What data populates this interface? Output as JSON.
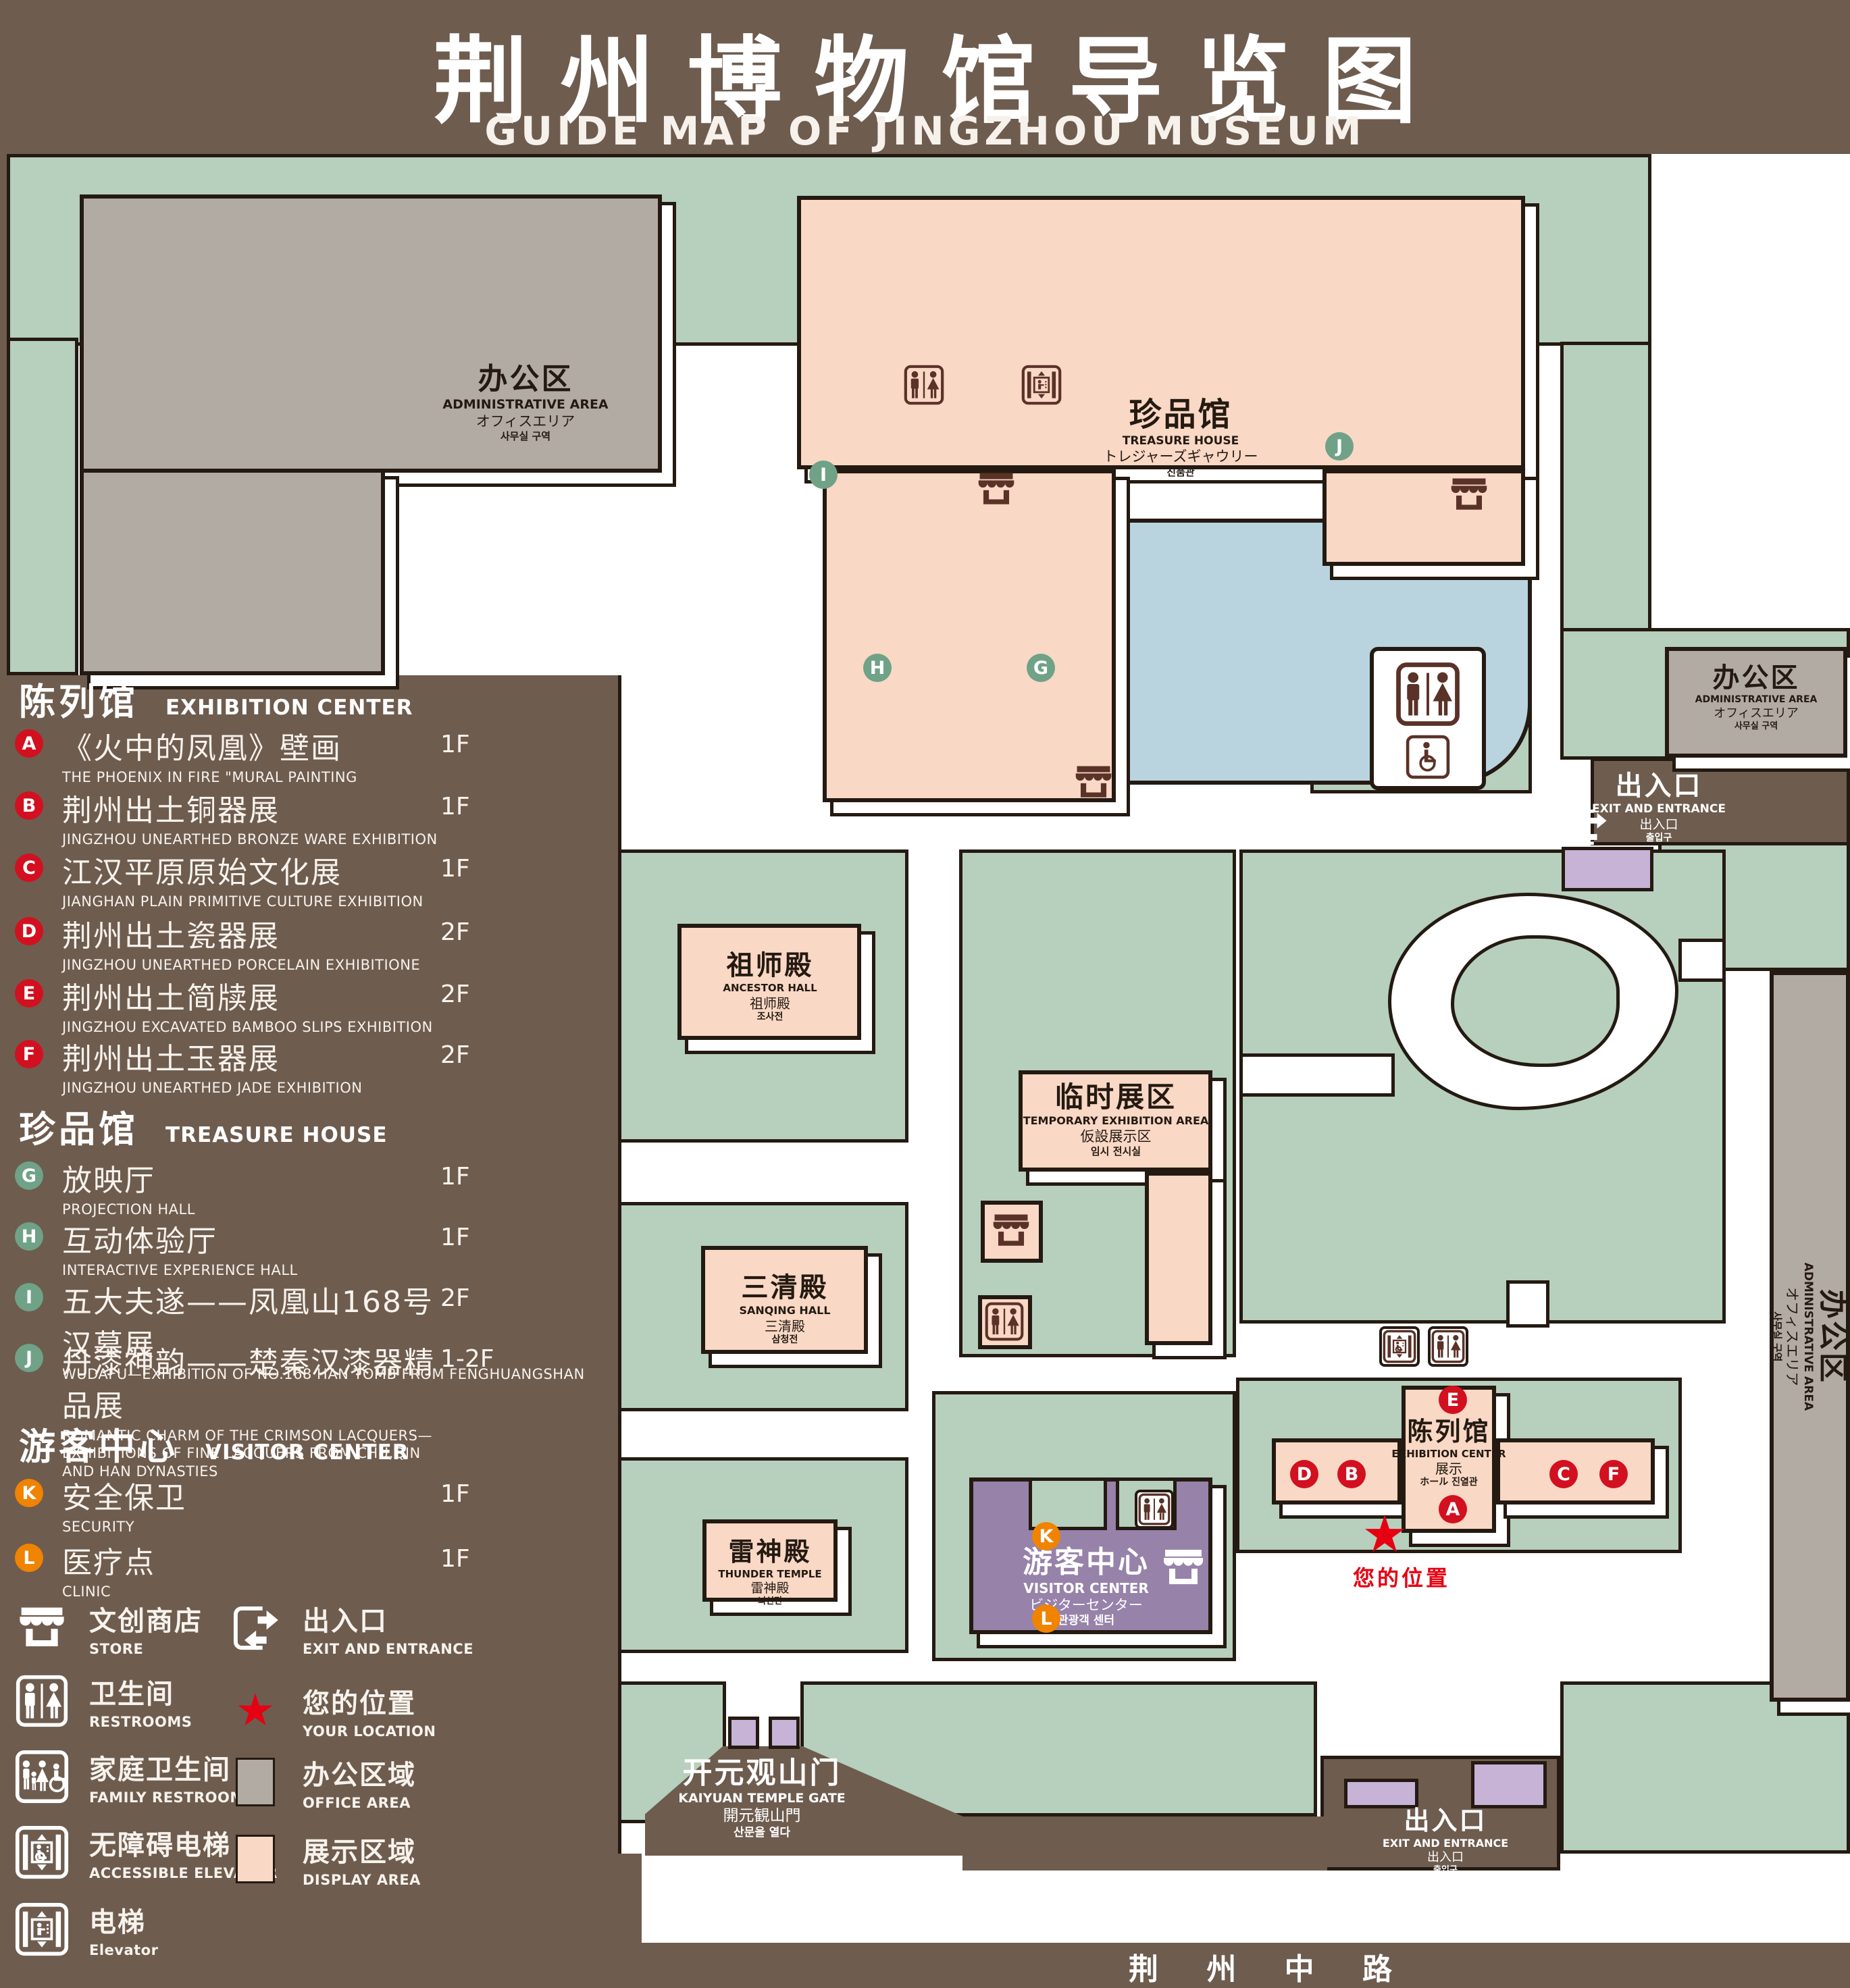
{
  "title": {
    "cn": "荆州博物馆导览图",
    "en": "GUIDE MAP OF JINGZHOU MUSEUM"
  },
  "colors": {
    "background": "#6e5c4f",
    "outline": "#241a12",
    "courtyard_green": "#b7cfbd",
    "display_pink": "#f9d8c5",
    "office_gray": "#b2aba4",
    "visitor_purple": "#9782aa",
    "gate_light_purple": "#c6b3d6",
    "pond_blue": "#b9d4de",
    "marker_red": "#d2101f",
    "marker_green": "#6fa287",
    "marker_orange": "#f08300",
    "location_red": "#e60012"
  },
  "legend": {
    "sections": [
      {
        "cn": "陈列馆",
        "en": "EXHIBITION CENTER",
        "items": [
          {
            "id": "A",
            "cn": "《火中的凤凰》壁画",
            "en": "THE PHOENIX IN FIRE \"MURAL PAINTING",
            "floor": "1F"
          },
          {
            "id": "B",
            "cn": "荆州出土铜器展",
            "en": "JINGZHOU UNEARTHED BRONZE WARE EXHIBITION",
            "floor": "1F"
          },
          {
            "id": "C",
            "cn": "江汉平原原始文化展",
            "en": "JIANGHAN PLAIN PRIMITIVE CULTURE EXHIBITION",
            "floor": "1F"
          },
          {
            "id": "D",
            "cn": "荆州出土瓷器展",
            "en": "JINGZHOU UNEARTHED PORCELAIN EXHIBITIONE",
            "floor": "2F"
          },
          {
            "id": "E",
            "cn": "荆州出土简牍展",
            "en": "JINGZHOU EXCAVATED BAMBOO SLIPS EXHIBITION",
            "floor": "2F"
          },
          {
            "id": "F",
            "cn": "荆州出土玉器展",
            "en": "JINGZHOU UNEARTHED JADE EXHIBITION",
            "floor": "2F"
          }
        ]
      },
      {
        "cn": "珍品馆",
        "en": "TREASURE HOUSE",
        "items": [
          {
            "id": "G",
            "cn": "放映厅",
            "en": "PROJECTION HALL",
            "floor": "1F"
          },
          {
            "id": "H",
            "cn": "互动体验厅",
            "en": "INTERACTIVE EXPERIENCE HALL",
            "floor": "1F"
          },
          {
            "id": "I",
            "cn": "五大夫遂——凤凰山168号汉墓展",
            "en": "WUDAFU—EXHIBITION OF NO.168 HAN TOMB FROM FENGHUANGSHAN",
            "floor": "2F"
          },
          {
            "id": "J",
            "cn": "丹漆神韵——楚秦汉漆器精品展",
            "en": "ROMANTIC CHARM OF THE CRIMSON LACQUERS—EXHIBITIONS OF FINE LACQUERS FROM CHU,QIN AND HAN DYNASTIES",
            "floor": "1-2F"
          }
        ]
      },
      {
        "cn": "游客中心",
        "en": "VISITOR CENTER",
        "items": [
          {
            "id": "K",
            "cn": "安全保卫",
            "en": "SECURITY",
            "floor": "1F"
          },
          {
            "id": "L",
            "cn": "医疗点",
            "en": "CLINIC",
            "floor": "1F"
          }
        ]
      }
    ],
    "symbols_left": [
      {
        "icon": "store-icon",
        "cn": "文创商店",
        "en": "STORE"
      },
      {
        "icon": "restrooms-icon",
        "cn": "卫生间",
        "en": "RESTROOMS"
      },
      {
        "icon": "family-restrooms-icon",
        "cn": "家庭卫生间",
        "en": "FAMILY RESTROOMS"
      },
      {
        "icon": "accessible-elevator-icon",
        "cn": "无障碍电梯",
        "en": "ACCESSIBLE ELEVATOR"
      },
      {
        "icon": "elevator-icon",
        "cn": "电梯",
        "en": "Elevator"
      }
    ],
    "symbols_right": [
      {
        "icon": "exit-icon",
        "cn": "出入口",
        "en": "EXIT AND ENTRANCE"
      },
      {
        "icon": "location-star",
        "cn": "您的位置",
        "en": "YOUR LOCATION"
      },
      {
        "icon": "office-swatch",
        "cn": "办公区域",
        "en": "OFFICE AREA"
      },
      {
        "icon": "display-swatch",
        "cn": "展示区域",
        "en": "DISPLAY AREA"
      }
    ]
  },
  "map": {
    "admin": {
      "cn": "办公区",
      "en": "ADMINISTRATIVE AREA",
      "jp": "オフィスエリア",
      "kr": "사무실 구역"
    },
    "treasure_house": {
      "cn": "珍品馆",
      "en": "TREASURE HOUSE",
      "jp": "トレジャーズギャウリー",
      "kr": "진품관"
    },
    "ancestor_hall": {
      "cn": "祖师殿",
      "en": "ANCESTOR HALL",
      "jp": "祖师殿",
      "kr": "조사전"
    },
    "temporary_area": {
      "cn": "临时展区",
      "en": "TEMPORARY EXHIBITION AREA",
      "jp": "仮設展示区",
      "kr": "임시 전시실"
    },
    "sanqing_hall": {
      "cn": "三清殿",
      "en": "SANQING HALL",
      "jp": "三清殿",
      "kr": "삼청전"
    },
    "thunder_temple": {
      "cn": "雷神殿",
      "en": "THUNDER TEMPLE",
      "jp": "雷神殿",
      "kr": "뇌신전"
    },
    "visitor_center": {
      "cn": "游客中心",
      "en": "VISITOR CENTER",
      "jp": "ビジターセンター",
      "kr": "관광객 센터"
    },
    "exhibition_center": {
      "cn": "陈列馆",
      "en": "EXHIBITION CENTER",
      "line3": "展示",
      "line4": "ホール 진열관"
    },
    "exit": {
      "cn": "出入口",
      "en": "EXIT AND ENTRANCE",
      "jp": "出入口",
      "kr": "출입구"
    },
    "kaiyuan_gate": {
      "cn": "开元观山门",
      "en": "KAIYUAN TEMPLE GATE",
      "jp": "開元観山門",
      "kr": "산문을 열다"
    },
    "road": "荆 州 中 路",
    "your_location": "您的位置",
    "markers": {
      "A": "A",
      "B": "B",
      "C": "C",
      "D": "D",
      "E": "E",
      "F": "F",
      "G": "G",
      "H": "H",
      "I": "I",
      "J": "J",
      "K": "K",
      "L": "L"
    }
  }
}
